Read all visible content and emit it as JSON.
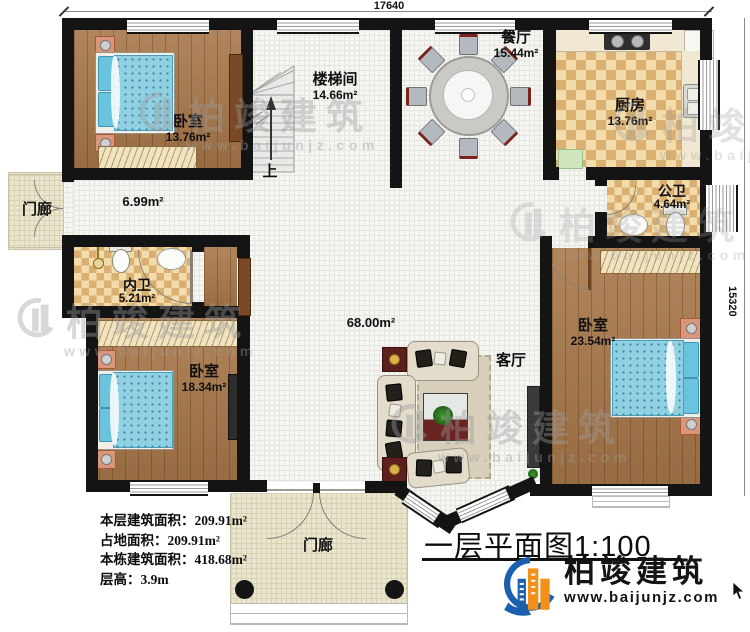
{
  "dimensions": {
    "top": "17640",
    "right": "15320"
  },
  "rooms": {
    "bedroom_top_left": {
      "name": "卧室",
      "area": "13.76m²"
    },
    "stairwell": {
      "name": "楼梯间",
      "area": "14.66m²",
      "up_label": "上"
    },
    "dining": {
      "name": "餐厅",
      "area": "15.44m²"
    },
    "kitchen": {
      "name": "厨房",
      "area": "13.76m²"
    },
    "public_bathroom": {
      "name": "公卫",
      "area": "4.64m²"
    },
    "corridor": {
      "area": "6.99m²"
    },
    "left_porch": {
      "name": "门廊"
    },
    "inner_bathroom": {
      "name": "内卫",
      "area": "5.21m²"
    },
    "bedroom_bottom_left": {
      "name": "卧室",
      "area": "18.34m²"
    },
    "hall": {
      "area": "68.00m²"
    },
    "living_room": {
      "name": "客厅"
    },
    "bedroom_bottom_right": {
      "name": "卧室",
      "area": "23.54m²"
    },
    "front_porch": {
      "name": "门廊"
    }
  },
  "stats": {
    "lines": [
      "本层建筑面积：209.91m²",
      "占地面积：209.91m²",
      "本栋建筑面积：418.68m²",
      "层高：3.9m"
    ]
  },
  "title": {
    "text": "一层平面图1:100"
  },
  "brand": {
    "name": "柏竣建筑",
    "website": "www.baijunjz.com"
  },
  "watermark": {
    "text": "柏竣建筑",
    "url": "www.baijunjz.com"
  },
  "colors": {
    "wall": "#141414",
    "brand_blue": "#1b5fae",
    "brand_orange": "#f39019"
  }
}
